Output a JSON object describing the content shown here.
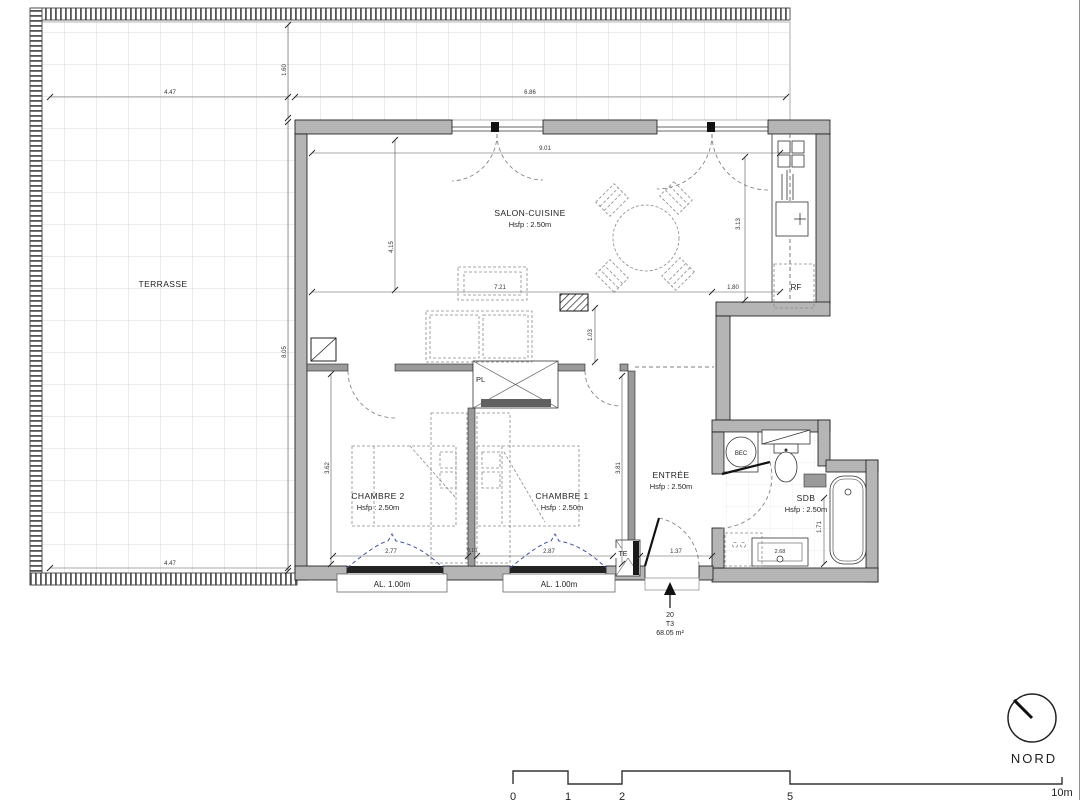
{
  "plan": {
    "rooms": {
      "terrasse": "TERRASSE",
      "salon": "SALON-CUISINE",
      "salon_h": "Hsfp : 2.50m",
      "chambre2": "CHAMBRE 2",
      "chambre2_h": "Hsfp : 2.50m",
      "chambre1": "CHAMBRE 1",
      "chambre1_h": "Hsfp : 2.50m",
      "entree": "ENTRÉE",
      "entree_h": "Hsfp : 2.50m",
      "sdb": "SDB",
      "sdb_h": "Hsfp : 2.50m"
    },
    "fixtures": {
      "pl": "PL",
      "te": "TE",
      "bec": "BEC",
      "rf": "RF",
      "al_left": "AL. 1.00m",
      "al_right": "AL. 1.00m",
      "vanity": "2.68"
    },
    "dims": {
      "terrace_top_w": "4.47",
      "terrace_top_h": "1.60",
      "facade_top": "6.86",
      "terrace_left_h": "8.05",
      "terrace_bottom_w": "4.47",
      "salon_w": "9.01",
      "salon_left_h": "4.15",
      "kitchen_right_h": "3.13",
      "salon_inner_w": "7.21",
      "fridge_w": "1.80",
      "passage_h": "1.03",
      "chambre2_left_h": "3.62",
      "chambre1_right_h": "3.81",
      "chambre2_w": "2.77",
      "wall_gap": "0.10",
      "chambre1_w": "2.87",
      "entree_w": "1.37",
      "sdb_right_h": "1.71"
    },
    "unit": {
      "number": "20",
      "type": "T3",
      "area": "68.05 m²"
    },
    "compass_label": "NORD",
    "scale": {
      "m0": "0",
      "m1": "1",
      "m2": "2",
      "m5": "5",
      "m10": "10m"
    },
    "colors": {
      "wall": "#b5b5b5",
      "curtain": "#3f51a3",
      "grid": "#d9d9d9"
    }
  }
}
